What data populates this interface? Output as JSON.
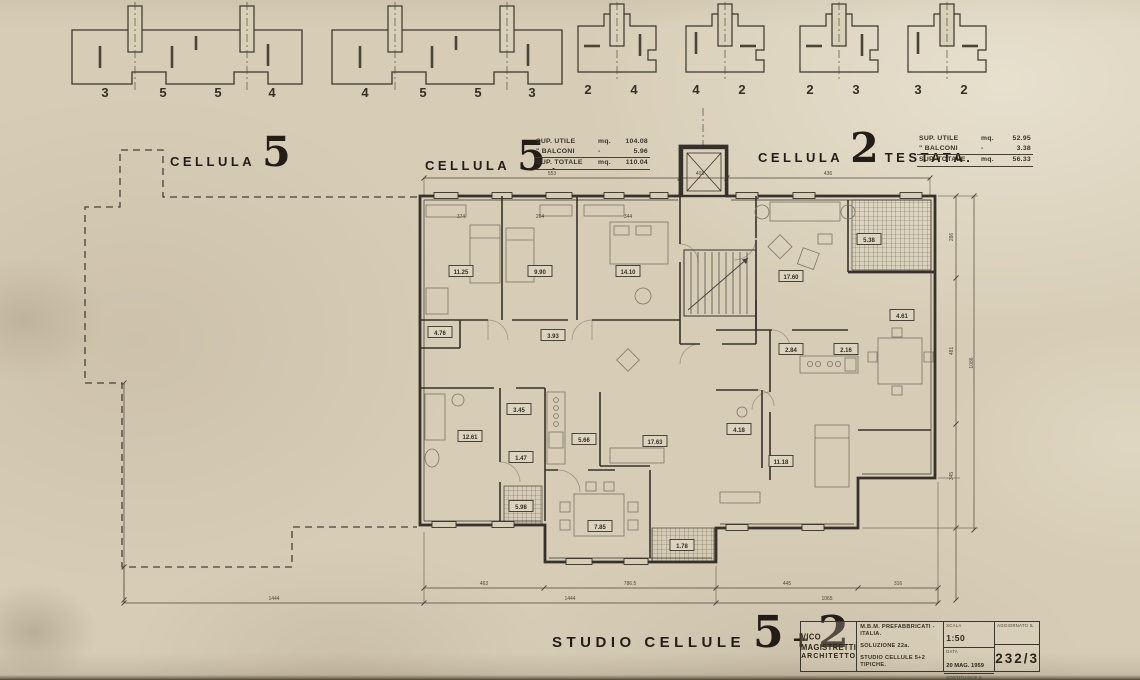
{
  "drawing": {
    "headers": {
      "left": {
        "word": "CELLULA",
        "num": "5",
        "suffix": ""
      },
      "mid": {
        "word": "CELLULA",
        "num": "5",
        "suffix": "."
      },
      "right": {
        "word": "CELLULA",
        "num": "2",
        "suffix": "TESTATA."
      }
    },
    "area_tables": [
      {
        "rows": [
          {
            "label": "SUP. UTILE",
            "unit": "mq.",
            "value": "104.08"
          },
          {
            "label": "\"  BALCONI",
            "unit": "-",
            "value": "5.96"
          },
          {
            "label": "SUP. TOTALE",
            "unit": "mq.",
            "value": "110.04"
          }
        ]
      },
      {
        "rows": [
          {
            "label": "SUP. UTILE",
            "unit": "mq.",
            "value": "52.95"
          },
          {
            "label": "\"  BALCONI",
            "unit": "-",
            "value": "3.38"
          },
          {
            "label": "SUP. TOTALE",
            "unit": "mq.",
            "value": "56.33"
          }
        ]
      }
    ],
    "footer": {
      "text": "STUDIO CELLULE",
      "num1": "5",
      "plus": "+",
      "num2": "2"
    },
    "title_block": {
      "architect_line1": "VICO MAGISTRETTI",
      "architect_line2": "ARCHITETTO",
      "client": "M.B.M. PREFABBRICATI - ITALIA.",
      "solution": "SOLUZIONE 22a.",
      "subject": "STUDIO CELLULE 5+2 TIPICHE.",
      "scala_label": "SCALA",
      "scala_value": "1:50",
      "data_label": "DATA",
      "data_value": "20 MAG. 1959",
      "sostituisce_label": "SOSTITUISCE IL",
      "aggiornato_label": "AGGIORNATO IL",
      "drawing_number": "232/3"
    },
    "top_diagrams": [
      {
        "numbers": [
          "3",
          "5",
          "5",
          "4"
        ]
      },
      {
        "numbers": [
          "4",
          "5",
          "5",
          "3"
        ]
      },
      {
        "numbers": [
          "2",
          "4"
        ]
      },
      {
        "numbers": [
          "4",
          "2"
        ]
      },
      {
        "numbers": [
          "2",
          "3"
        ]
      },
      {
        "numbers": [
          "3",
          "2"
        ]
      }
    ],
    "plan": {
      "room_labels": [
        {
          "v": "11.25",
          "x": 461,
          "y": 272
        },
        {
          "v": "9.90",
          "x": 540,
          "y": 272
        },
        {
          "v": "14.10",
          "x": 628,
          "y": 272
        },
        {
          "v": "4.76",
          "x": 440,
          "y": 333
        },
        {
          "v": "3.93",
          "x": 553,
          "y": 336
        },
        {
          "v": "12.61",
          "x": 470,
          "y": 437
        },
        {
          "v": "3.45",
          "x": 519,
          "y": 410
        },
        {
          "v": "1.47",
          "x": 521,
          "y": 458
        },
        {
          "v": "5.66",
          "x": 584,
          "y": 440
        },
        {
          "v": "17.63",
          "x": 655,
          "y": 442
        },
        {
          "v": "5.98",
          "x": 521,
          "y": 507
        },
        {
          "v": "7.85",
          "x": 600,
          "y": 527
        },
        {
          "v": "1.78",
          "x": 682,
          "y": 546
        },
        {
          "v": "17.60",
          "x": 791,
          "y": 277
        },
        {
          "v": "5.38",
          "x": 869,
          "y": 240
        },
        {
          "v": "4.61",
          "x": 902,
          "y": 316
        },
        {
          "v": "2.84",
          "x": 791,
          "y": 350
        },
        {
          "v": "2.16",
          "x": 846,
          "y": 350
        },
        {
          "v": "11.18",
          "x": 781,
          "y": 462
        },
        {
          "v": "4.18",
          "x": 739,
          "y": 430
        }
      ],
      "dim_labels": [
        {
          "v": "553",
          "x": 552,
          "y": 175
        },
        {
          "v": "403",
          "x": 700,
          "y": 175
        },
        {
          "v": "436",
          "x": 828,
          "y": 175
        },
        {
          "v": "374",
          "x": 461,
          "y": 218
        },
        {
          "v": "264",
          "x": 540,
          "y": 218
        },
        {
          "v": "344",
          "x": 628,
          "y": 218
        },
        {
          "v": "463",
          "x": 484,
          "y": 585
        },
        {
          "v": "786.5",
          "x": 630,
          "y": 585
        },
        {
          "v": "445",
          "x": 787,
          "y": 585
        },
        {
          "v": "316",
          "x": 898,
          "y": 585
        },
        {
          "v": "1444",
          "x": 274,
          "y": 600
        },
        {
          "v": "1444",
          "x": 570,
          "y": 600
        },
        {
          "v": "1065",
          "x": 827,
          "y": 600
        }
      ],
      "dim_labels_rotated": [
        {
          "v": "286",
          "x": 953,
          "y": 237
        },
        {
          "v": "481",
          "x": 953,
          "y": 351
        },
        {
          "v": "345",
          "x": 953,
          "y": 476
        },
        {
          "v": "1086",
          "x": 973,
          "y": 363
        }
      ]
    }
  }
}
